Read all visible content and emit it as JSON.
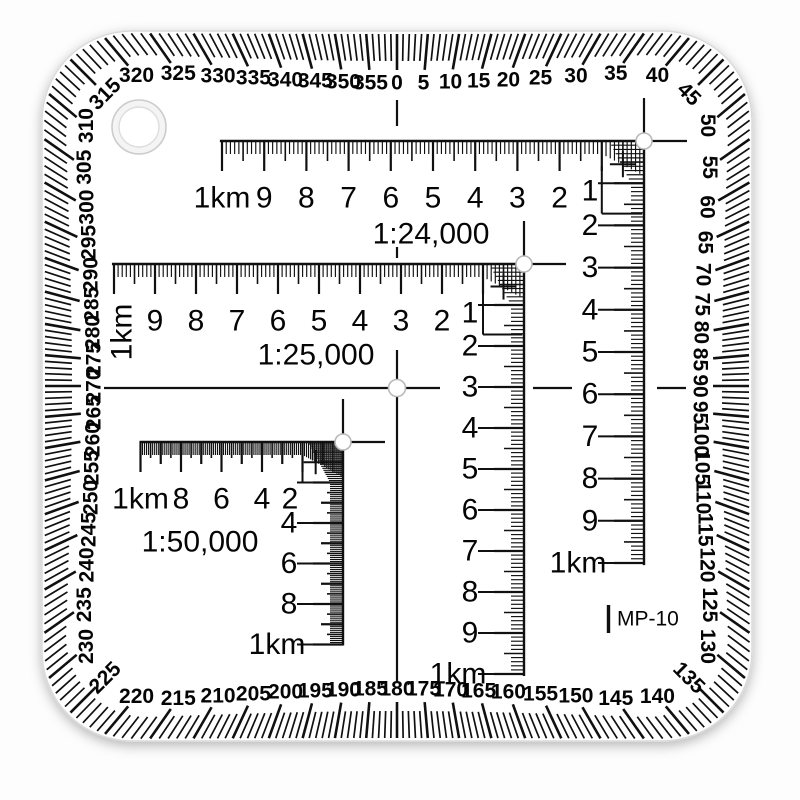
{
  "model_label": "MP-10",
  "colors": {
    "ink": "#101010",
    "body": "#ffffff",
    "edge": "#dadada",
    "hole_ring": "#cccccc",
    "shadow": "rgba(0,0,0,0.30)"
  },
  "degree_ring": {
    "label_step": 5,
    "tick_step": 1,
    "labels": [
      "0",
      "5",
      "10",
      "15",
      "20",
      "25",
      "30",
      "35",
      "40",
      "45",
      "50",
      "55",
      "60",
      "65",
      "70",
      "75",
      "80",
      "85",
      "90",
      "95",
      "100",
      "105",
      "110",
      "115",
      "120",
      "125",
      "130",
      "135",
      "140",
      "145",
      "150",
      "155",
      "160",
      "165",
      "170",
      "175",
      "180",
      "185",
      "190",
      "195",
      "200",
      "205",
      "210",
      "215",
      "220",
      "225",
      "230",
      "235",
      "240",
      "245",
      "250",
      "255",
      "260",
      "265",
      "270",
      "275",
      "280",
      "285",
      "290",
      "295",
      "300",
      "305",
      "310",
      "315",
      "320",
      "325",
      "330",
      "335",
      "340",
      "345",
      "350",
      "355"
    ]
  },
  "scales": [
    {
      "id": "scale-24000",
      "ratio_label": "1:24,000",
      "unit_label": "1km",
      "horizontal_labels": [
        "1km",
        "9",
        "8",
        "7",
        "6",
        "5",
        "4",
        "3",
        "2"
      ],
      "vertical_labels": [
        "1",
        "2",
        "3",
        "4",
        "5",
        "6",
        "7",
        "8",
        "9",
        "1km"
      ]
    },
    {
      "id": "scale-25000",
      "ratio_label": "1:25,000",
      "unit_label": "1km",
      "horizontal_labels": [
        "1km",
        "9",
        "8",
        "7",
        "6",
        "5",
        "4",
        "3",
        "2"
      ],
      "vertical_labels": [
        "1",
        "2",
        "3",
        "4",
        "5",
        "6",
        "7",
        "8",
        "9",
        "1km"
      ]
    },
    {
      "id": "scale-50000",
      "ratio_label": "1:50,000",
      "unit_label": "1km",
      "horizontal_labels": [
        "1km",
        "8",
        "6",
        "4",
        "2"
      ],
      "vertical_labels": [
        "4",
        "6",
        "8",
        "1km"
      ]
    }
  ]
}
